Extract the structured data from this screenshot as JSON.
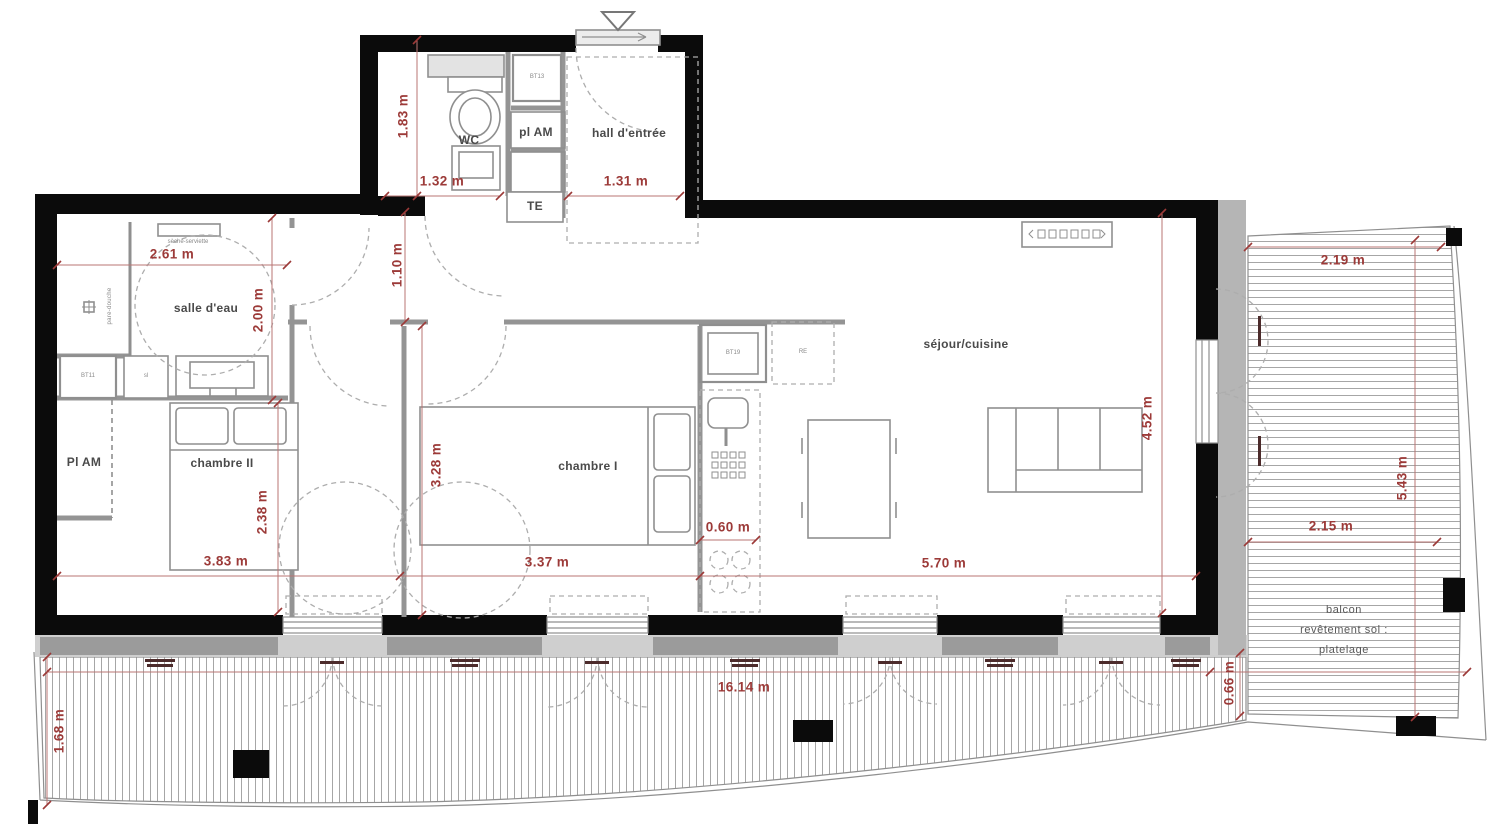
{
  "colors": {
    "wall": "#0b0b0b",
    "dimension_red": "#9c3a38",
    "partition_gray": "#949494",
    "deck_line": "#a6a6a6"
  },
  "rooms": {
    "wc": "WC",
    "pl_am_top": "pl AM",
    "hall": "hall d'entrée",
    "te": "TE",
    "salle_deau": "salle d'eau",
    "seche_serviette": "sèche-serviette",
    "pare_douche": "pare-douche",
    "pl_am_left": "Pl AM",
    "chambre2": "chambre II",
    "chambre1": "chambre I",
    "sejour": "séjour/cuisine"
  },
  "balcony": {
    "line1": "balcon",
    "line2": "revêtement sol :",
    "line3": "platelage"
  },
  "tags": {
    "bt13": "BT13",
    "bt11": "BT11",
    "sl": "sl",
    "bt19": "BT19",
    "re": "RE"
  },
  "dims": {
    "d183": "1.83 m",
    "d132": "1.32 m",
    "d131": "1.31 m",
    "d261": "2.61 m",
    "d200": "2.00 m",
    "d110": "1.10 m",
    "d219": "2.19 m",
    "d452": "4.52 m",
    "d328": "3.28 m",
    "d238": "2.38 m",
    "d383": "3.83 m",
    "d337": "3.37 m",
    "d060": "0.60 m",
    "d570": "5.70 m",
    "d215": "2.15 m",
    "d543": "5.43 m",
    "d1614": "16.14 m",
    "d066": "0.66 m",
    "d168": "1.68 m"
  }
}
